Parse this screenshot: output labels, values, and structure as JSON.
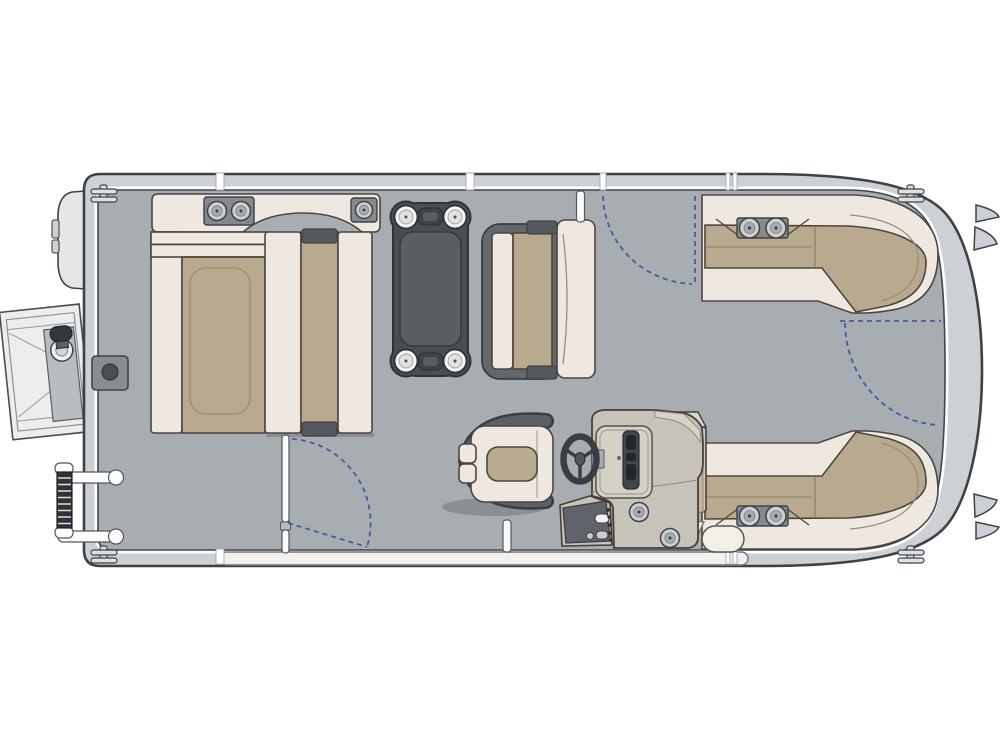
{
  "title": "Pontoon boat deck floor plan, top view, bow at right",
  "canvas": {
    "width": 1000,
    "height": 750
  },
  "colors": {
    "background": "#ffffff",
    "hull_band": "#cdd1d5",
    "hull_outline": "#3d4247",
    "deck": "#a8adb2",
    "deck_edge": "#41464b",
    "cream": "#eee8e0",
    "seat_stroke": "#4b473f",
    "tan": "#b9a98f",
    "seam": "#9a8e76",
    "table_rim": "#4b4e51",
    "table_panel": "#5a5d61",
    "table_edge": "#2f3236",
    "pad_gray": "#85898e",
    "cup_light": "#ccd0d3",
    "cup_mid": "#a9adb1",
    "dark_dot": "#3c4043",
    "frame_gray": "#64686c",
    "bracket_gray": "#55585c",
    "console": "#c8c3b9",
    "console_stroke": "#45413a",
    "console_facet": "#d8d3c9",
    "dash_panel": "#d6d1c7",
    "instrument": "#43474c",
    "slot": "#23272b",
    "wheel": "#3a3e42",
    "wrap": "#5d6165",
    "wrap_edge": "#3a3e42",
    "swing_blue": "#4c57a8",
    "box_gray": "#8a8e93",
    "platform": "#eceded",
    "platform_panel": "#b9bdc1",
    "ladder": "#2f3337",
    "strip": "#f3f1ef",
    "white": "#fdfdfd",
    "shadow": "rgba(70,75,80,0.3)"
  },
  "parts": {
    "stern_platform": "stern swim platform with boarding ladder",
    "motor_pod": "outboard motor pod",
    "folded_ladder": "folded boarding ladder with grab rails",
    "cleats": "mooring cleats at four corners",
    "stern_lounge": "wraparound stern lounge with cup-holder armrest",
    "flip_bench": "flip-flop bench seat",
    "table": "pedestal table with four cup holders",
    "mid_bench": "aft-facing bench seat",
    "port_gate": "port side entry gate with swing arc",
    "starboard_gate": "starboard side entry gate with swing arc",
    "bow_gate": "bow entry gate with swing arc",
    "helm": "helm console with steering wheel and switch panel",
    "captain_chair": "captain's chair",
    "starboard_bow_lounge": "starboard bow L-lounge with cup holders",
    "port_bow_lounge": "port bow L-lounge with cup holders"
  }
}
